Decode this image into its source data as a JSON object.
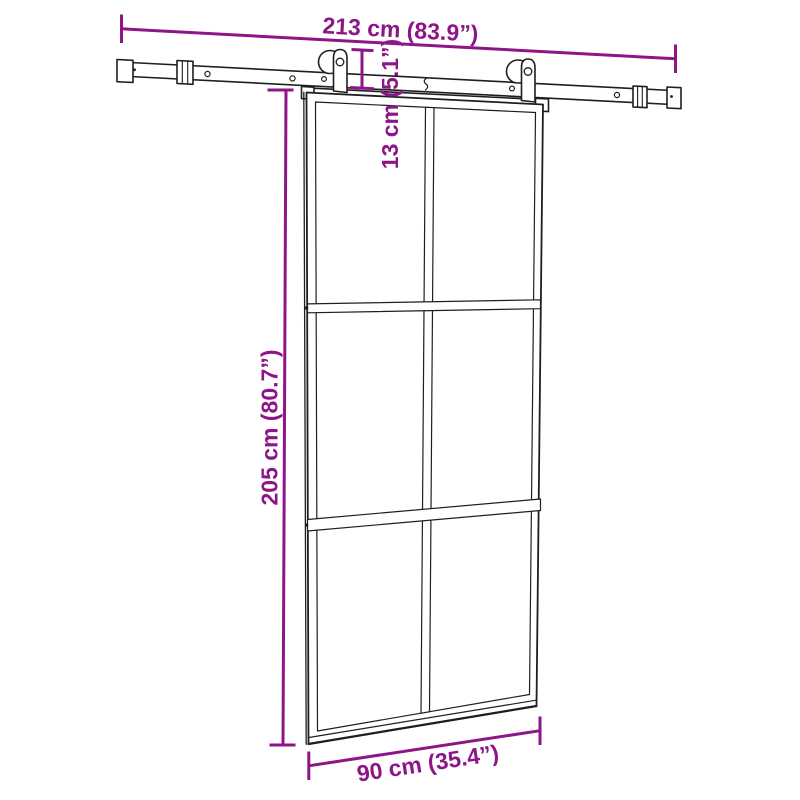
{
  "diagram": {
    "subject": "sliding glass door with top rail sliding hardware",
    "labels": {
      "rail_length": "213 cm (83.9”)",
      "hardware_height": "13 cm (5.1”)",
      "door_height": "205 cm (80.7”)",
      "door_width": "90 cm (35.4”)"
    },
    "colors": {
      "dimension": "#8E1588",
      "line_art": "#1f1f1f",
      "background": "#ffffff"
    }
  }
}
